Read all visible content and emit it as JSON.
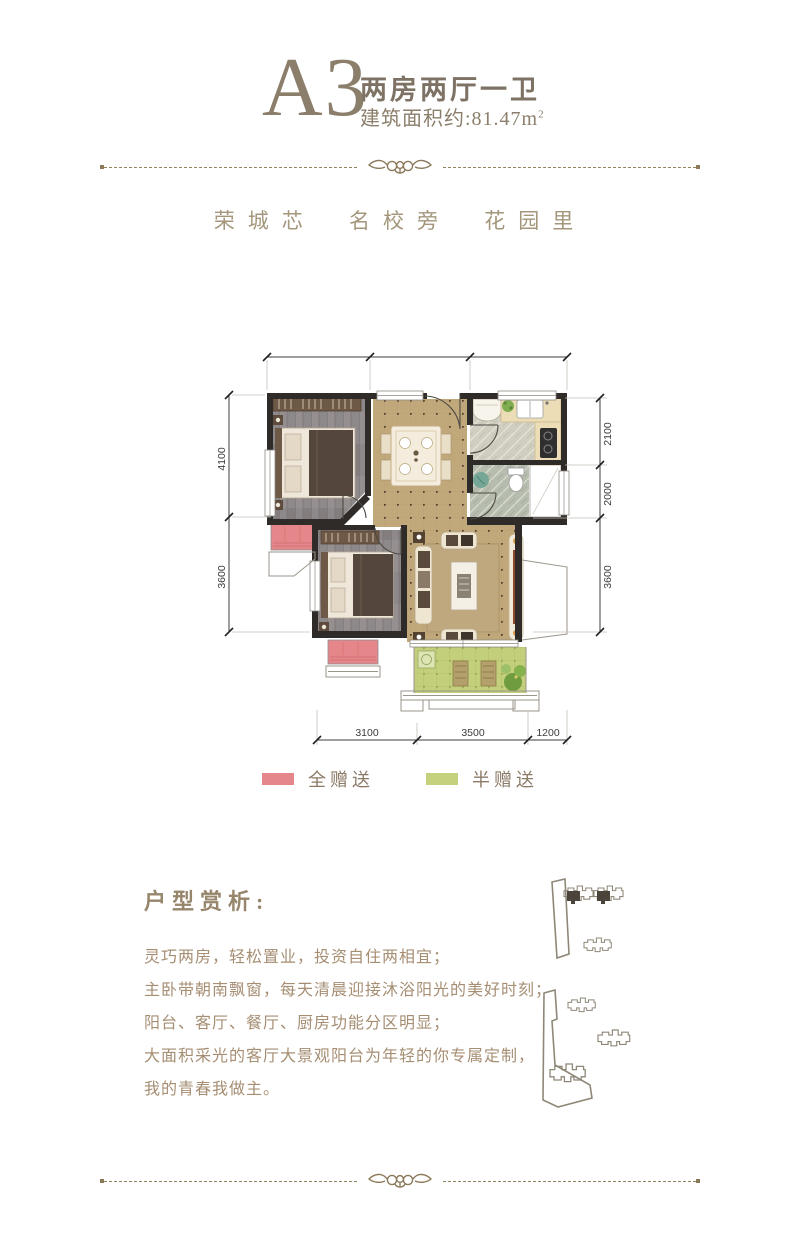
{
  "header": {
    "unit": "A3",
    "type": "两房两厅一卫",
    "area": "建筑面积约:81.47m",
    "area_sup": "2"
  },
  "tagline": {
    "item1": "荣城芯",
    "item2": "名校旁",
    "item3": "花园里"
  },
  "floorplan": {
    "dims": {
      "left": [
        "4100",
        "3600"
      ],
      "right": [
        "2100",
        "2000",
        "3600"
      ],
      "bottom": [
        "3100",
        "3500",
        "1200"
      ]
    }
  },
  "legend": {
    "full": {
      "label": "全赠送",
      "color": "#e5868a"
    },
    "half": {
      "label": "半赠送",
      "color": "#c6d17c"
    }
  },
  "analysis": {
    "heading": "户型赏析:",
    "lines": [
      "灵巧两房，轻松置业，投资自住两相宜；",
      "主卧带朝南飘窗，每天清晨迎接沐浴阳光的美好时刻；",
      "阳台、客厅、餐厅、厨房功能分区明显；",
      "大面积采光的客厅大景观阳台为年轻的你专属定制，",
      "我的青春我做主。"
    ]
  },
  "colors": {
    "accent_text": "#8b7e6b",
    "tagline_text": "#a3967b",
    "divider": "#8b795a",
    "wall": "#2e2b28",
    "wood_floor": "#8d8889",
    "tile_floor": "#c0a87c",
    "balcony": "#c6d17c",
    "full_gift_pink": "#e5868a",
    "half_gift_green": "#c6d17c"
  }
}
